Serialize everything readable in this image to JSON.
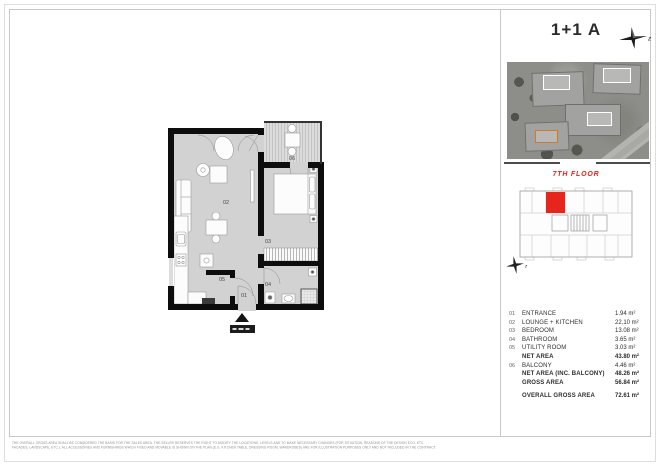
{
  "sheet": {
    "title": "1+1 A",
    "floor_label": "7TH FLOOR",
    "compass_letter": "z"
  },
  "plan": {
    "labels": {
      "entrance": "01",
      "lounge": "02",
      "bedroom": "03",
      "bathroom": "04",
      "utility": "05",
      "balcony": "06"
    }
  },
  "legend": {
    "rows": [
      {
        "num": "01",
        "label": "ENTRANCE",
        "value": "1.94 m²"
      },
      {
        "num": "02",
        "label": "LOUNGE + KITCHEN",
        "value": "22.10 m²"
      },
      {
        "num": "03",
        "label": "BEDROOM",
        "value": "13.08 m²"
      },
      {
        "num": "04",
        "label": "BATHROOM",
        "value": "3.65 m²"
      },
      {
        "num": "05",
        "label": "UTILITY ROOM",
        "value": "3.03 m²"
      },
      {
        "num": "",
        "label": "NET AREA",
        "value": "43.80 m²"
      },
      {
        "num": "06",
        "label": "BALCONY",
        "value": "4.46 m²"
      },
      {
        "num": "",
        "label": "NET AREA (INC. BALCONY)",
        "value": "48.26 m²"
      },
      {
        "num": "",
        "label": "GROSS AREA",
        "value": "56.84 m²"
      },
      {
        "num": "",
        "label": "OVERALL GROSS AREA",
        "value": "72.61 m²"
      }
    ]
  },
  "disclaimer": {
    "line1": "THE OVERALL GROSS AREA SHALL BE CONSIDERED THE BASIS FOR THE SALES AREA. THE SELLER RESERVES THE RIGHT TO MODIFY THE LOCATIONS, LEVELS AND TO MAKE NECESSARY CHANGES (FOR SITUATION, REASONS OF THE DESIGN ECO. ETC.",
    "line2": "FACADES, LANDSCAPE, ETC.). ALL ACCESSORIES AND FURNISHINGS WHICH FIXED AND MOVABLE IS SHOWN ON THE PLAN (E.G. KITCHEN TABLE, DRESSING ROOM, WARDROBES) ARE FOR ILLUSTRATION PURPOSES ONLY AND NOT INCLUDED IN THE CONTRACT."
  },
  "colors": {
    "unit_highlight_red": "#e8251d",
    "floor_label_red": "#e0251c",
    "photo_highlight_orange": "#d4782a",
    "floor_gray": "#d2d2d2",
    "wall_black": "#0d0d0d"
  }
}
